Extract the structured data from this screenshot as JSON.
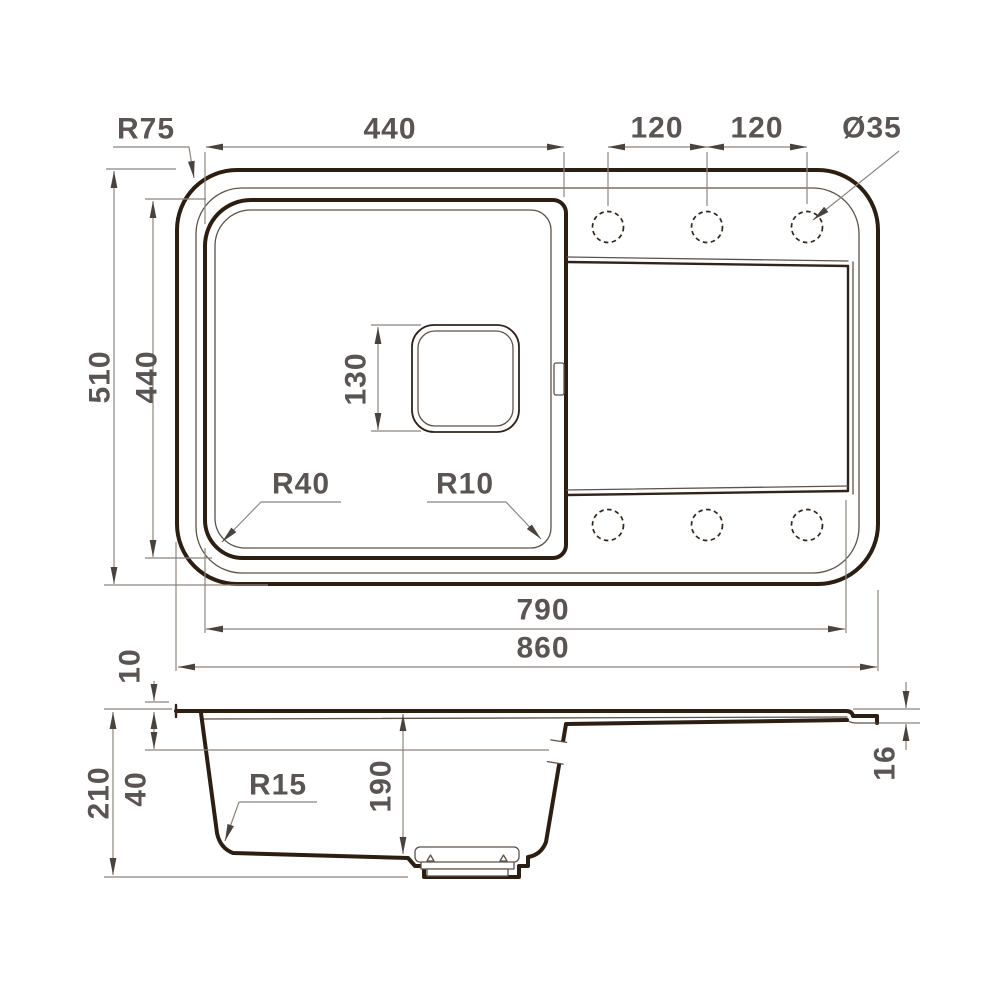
{
  "title": "Kitchen sink technical drawing, top view and section view",
  "colors": {
    "outline": "#2d1e12",
    "dimension_line": "#8d857d",
    "label_text": "#5a5552",
    "background": "#ffffff"
  },
  "top_view": {
    "corner_radius": "R75",
    "bowl_width": "440",
    "hole_spacing_left": "120",
    "hole_spacing_right": "120",
    "hole_diameter": "Ø35",
    "overall_depth": "510",
    "bowl_depth": "440",
    "drain_size": "130",
    "bowl_corner_radius_left": "R40",
    "bowl_corner_radius_right": "R10",
    "inner_length": "790",
    "overall_length": "860",
    "faucet_hole_count": 6
  },
  "side_view": {
    "rim_height": "10",
    "overall_height": "210",
    "ledge_depth": "40",
    "bottom_corner_radius": "R15",
    "bowl_inner_depth": "190",
    "edge_thickness": "16"
  }
}
